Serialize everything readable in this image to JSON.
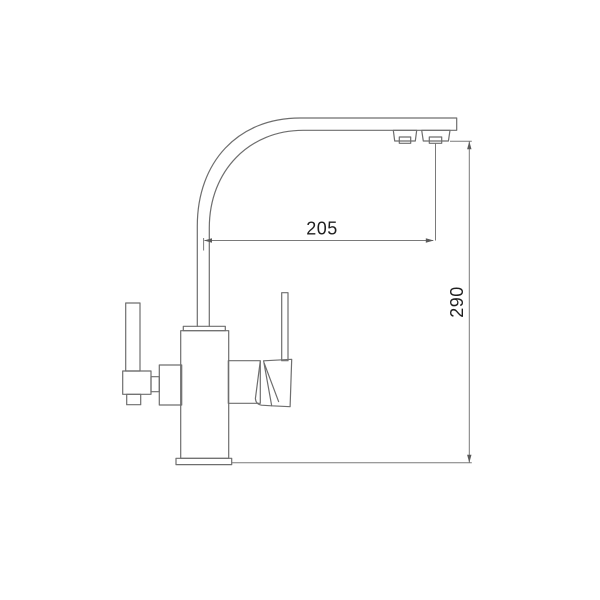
{
  "drawing": {
    "kind": "technical-line-drawing",
    "subject": "kitchen mixer faucet, side elevation with swan-neck spout, two levers and aerator outlets",
    "line_color": "#6e6e6e",
    "dimension_line_color": "#7a7a7a",
    "text_color": "#1f1f1f",
    "background_color": "#ffffff",
    "dimensions": [
      {
        "id": "spout-reach",
        "value": "205",
        "orientation": "horizontal"
      },
      {
        "id": "spout-height",
        "value": "290",
        "orientation": "vertical"
      }
    ]
  }
}
